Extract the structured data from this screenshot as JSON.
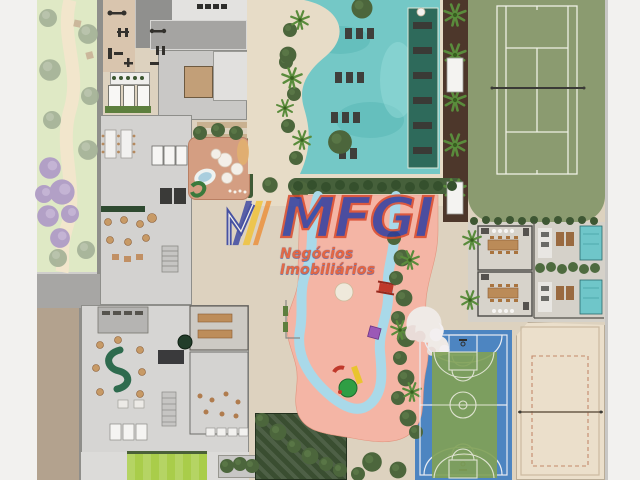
{
  "watermark": {
    "brand": "MFGI",
    "tagline": "Negócios Imobiliários",
    "brand_color": "#2b3a9e",
    "brand_outline_color": "#d8482c",
    "tagline_color": "#e4572f",
    "logo_stripe_colors": [
      "#2b3a9e",
      "#f2c12b",
      "#ec8a2e"
    ]
  },
  "site_plan": {
    "areas": [
      {
        "name": "park-garden",
        "color": "#dfe9c5"
      },
      {
        "name": "purple-flowering-trees",
        "color": "#b2a0c6"
      },
      {
        "name": "outdoor-gym",
        "color": "#d9c5ae"
      },
      {
        "name": "clubhouse-interiors",
        "color": "#d3d2d0"
      },
      {
        "name": "main-pool",
        "color": "#74c8c6"
      },
      {
        "name": "lap-pool",
        "color": "#2e6a5b"
      },
      {
        "name": "pool-deck",
        "color": "#e7dcc7"
      },
      {
        "name": "tennis-court",
        "color": "#8b9b70"
      },
      {
        "name": "kids-playground",
        "color": "#d49e82"
      },
      {
        "name": "kids-water-park",
        "color": "#f4b5a5"
      },
      {
        "name": "lazy-river",
        "color": "#a9d9e9"
      },
      {
        "name": "bbq-pavilions",
        "color": "#d5d1c9"
      },
      {
        "name": "private-spa-pools",
        "color": "#6fc6c9"
      },
      {
        "name": "basketball-court",
        "color": "#4d85c1"
      },
      {
        "name": "basketball-infield",
        "color": "#80a157"
      },
      {
        "name": "beach-volleyball-court",
        "color": "#ebdfcb"
      },
      {
        "name": "sports-lawn",
        "color": "#a9cd4a"
      }
    ]
  },
  "canvas": {
    "width": 640,
    "height": 480,
    "background": "#f2f1ef"
  }
}
